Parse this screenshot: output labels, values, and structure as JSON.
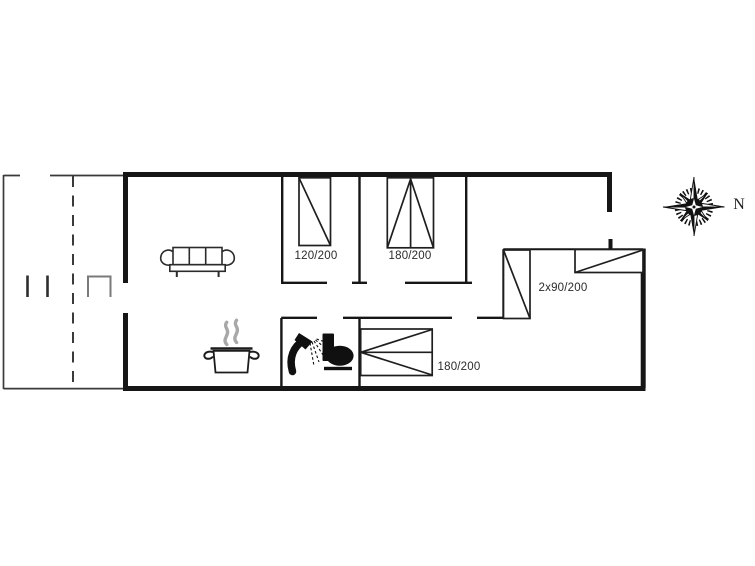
{
  "drawing": {
    "type": "holiday-home floor plan",
    "compass": {
      "label": "N"
    },
    "beds": {
      "bed1": {
        "label": "120/200"
      },
      "bed2": {
        "label": "180/200"
      },
      "bed3": {
        "label": "2x90/200"
      },
      "bed4": {
        "label": "180/200"
      }
    },
    "icons": {
      "sofa": "sofa-icon",
      "cooking_pot": "cooking-pot-icon",
      "steam": "steam-icon",
      "shower": "shower-icon",
      "toilet": "toilet-icon",
      "compass_rose": "compass-rose-icon",
      "terrace_table": "terrace-table-icon"
    },
    "colors": {
      "background": "#ffffff",
      "walls": "#161616",
      "terrace_line": "#3a3a3a",
      "furniture_line": "#2b2b2b",
      "fixtures": "#101010",
      "steam": "#a8a8a8",
      "label_text": "#2b2b2b"
    }
  }
}
